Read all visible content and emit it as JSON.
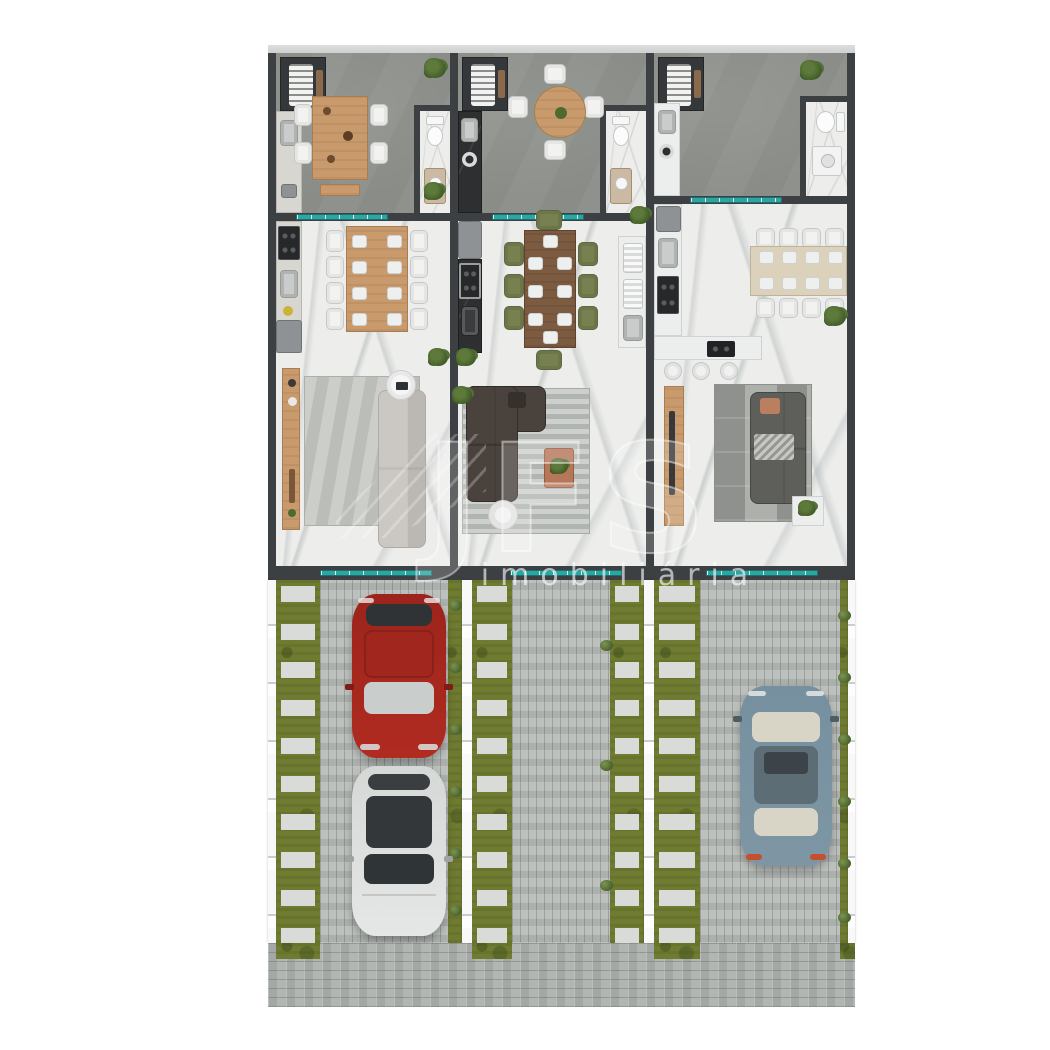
{
  "title": "three-unit townhouse floor plan rendering",
  "watermark": {
    "logo": "JFS",
    "label": "imobiliária"
  },
  "palette": {
    "background": "#ffffff",
    "wall": "#3d4042",
    "patio_floor": "#8f928c",
    "marble_floor": "#edeeec",
    "glass_teal": "#2ba7a3",
    "grass": "#6e7b31",
    "driveway_pavers": "#bdc1be",
    "sidewalk_pavers": "#b2b6b3",
    "fence_white": "#eceeed",
    "wood_light": "#c89a6c",
    "wood_dark": "#7d5b41",
    "chair_olive": "#76814f",
    "sofa_dark_brown": "#4a423d",
    "sofa_gray": "#5e5e5a",
    "car_red": "#a5261d",
    "car_white": "#dcdedd",
    "car_blue": "#7b93a2"
  },
  "units": [
    {
      "id": "unit-1",
      "rooms": [
        "patio-barbecue",
        "bathroom",
        "kitchen-dining",
        "living-room",
        "driveway"
      ],
      "cars": [
        "red-car",
        "white-car"
      ]
    },
    {
      "id": "unit-2",
      "rooms": [
        "patio-barbecue",
        "bathroom",
        "kitchen-dining",
        "living-room",
        "driveway"
      ],
      "cars": []
    },
    {
      "id": "unit-3",
      "rooms": [
        "patio-barbecue",
        "bathroom",
        "kitchen-dining",
        "living-room",
        "driveway"
      ],
      "cars": [
        "blue-car"
      ]
    }
  ],
  "cars": [
    {
      "name": "red-car",
      "color": "#a5261d",
      "location": "unit-1 driveway",
      "facing": "street"
    },
    {
      "name": "white-car",
      "color": "#dcdedd",
      "location": "unit-1 driveway",
      "facing": "street"
    },
    {
      "name": "blue-car",
      "color": "#7b93a2",
      "location": "unit-3 driveway",
      "facing": "house"
    }
  ]
}
